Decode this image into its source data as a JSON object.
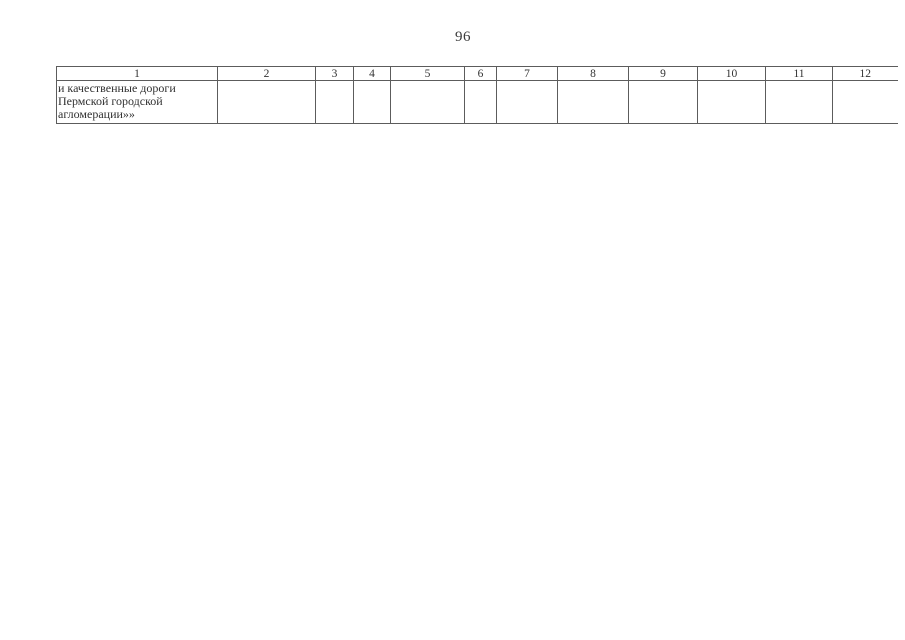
{
  "page": {
    "number": "96"
  },
  "table": {
    "headers": [
      "1",
      "2",
      "3",
      "4",
      "5",
      "6",
      "7",
      "8",
      "9",
      "10",
      "11",
      "12"
    ],
    "row": {
      "col1_lines": [
        "и качественные дороги",
        "Пермской городской",
        "агломерации»»"
      ]
    }
  }
}
